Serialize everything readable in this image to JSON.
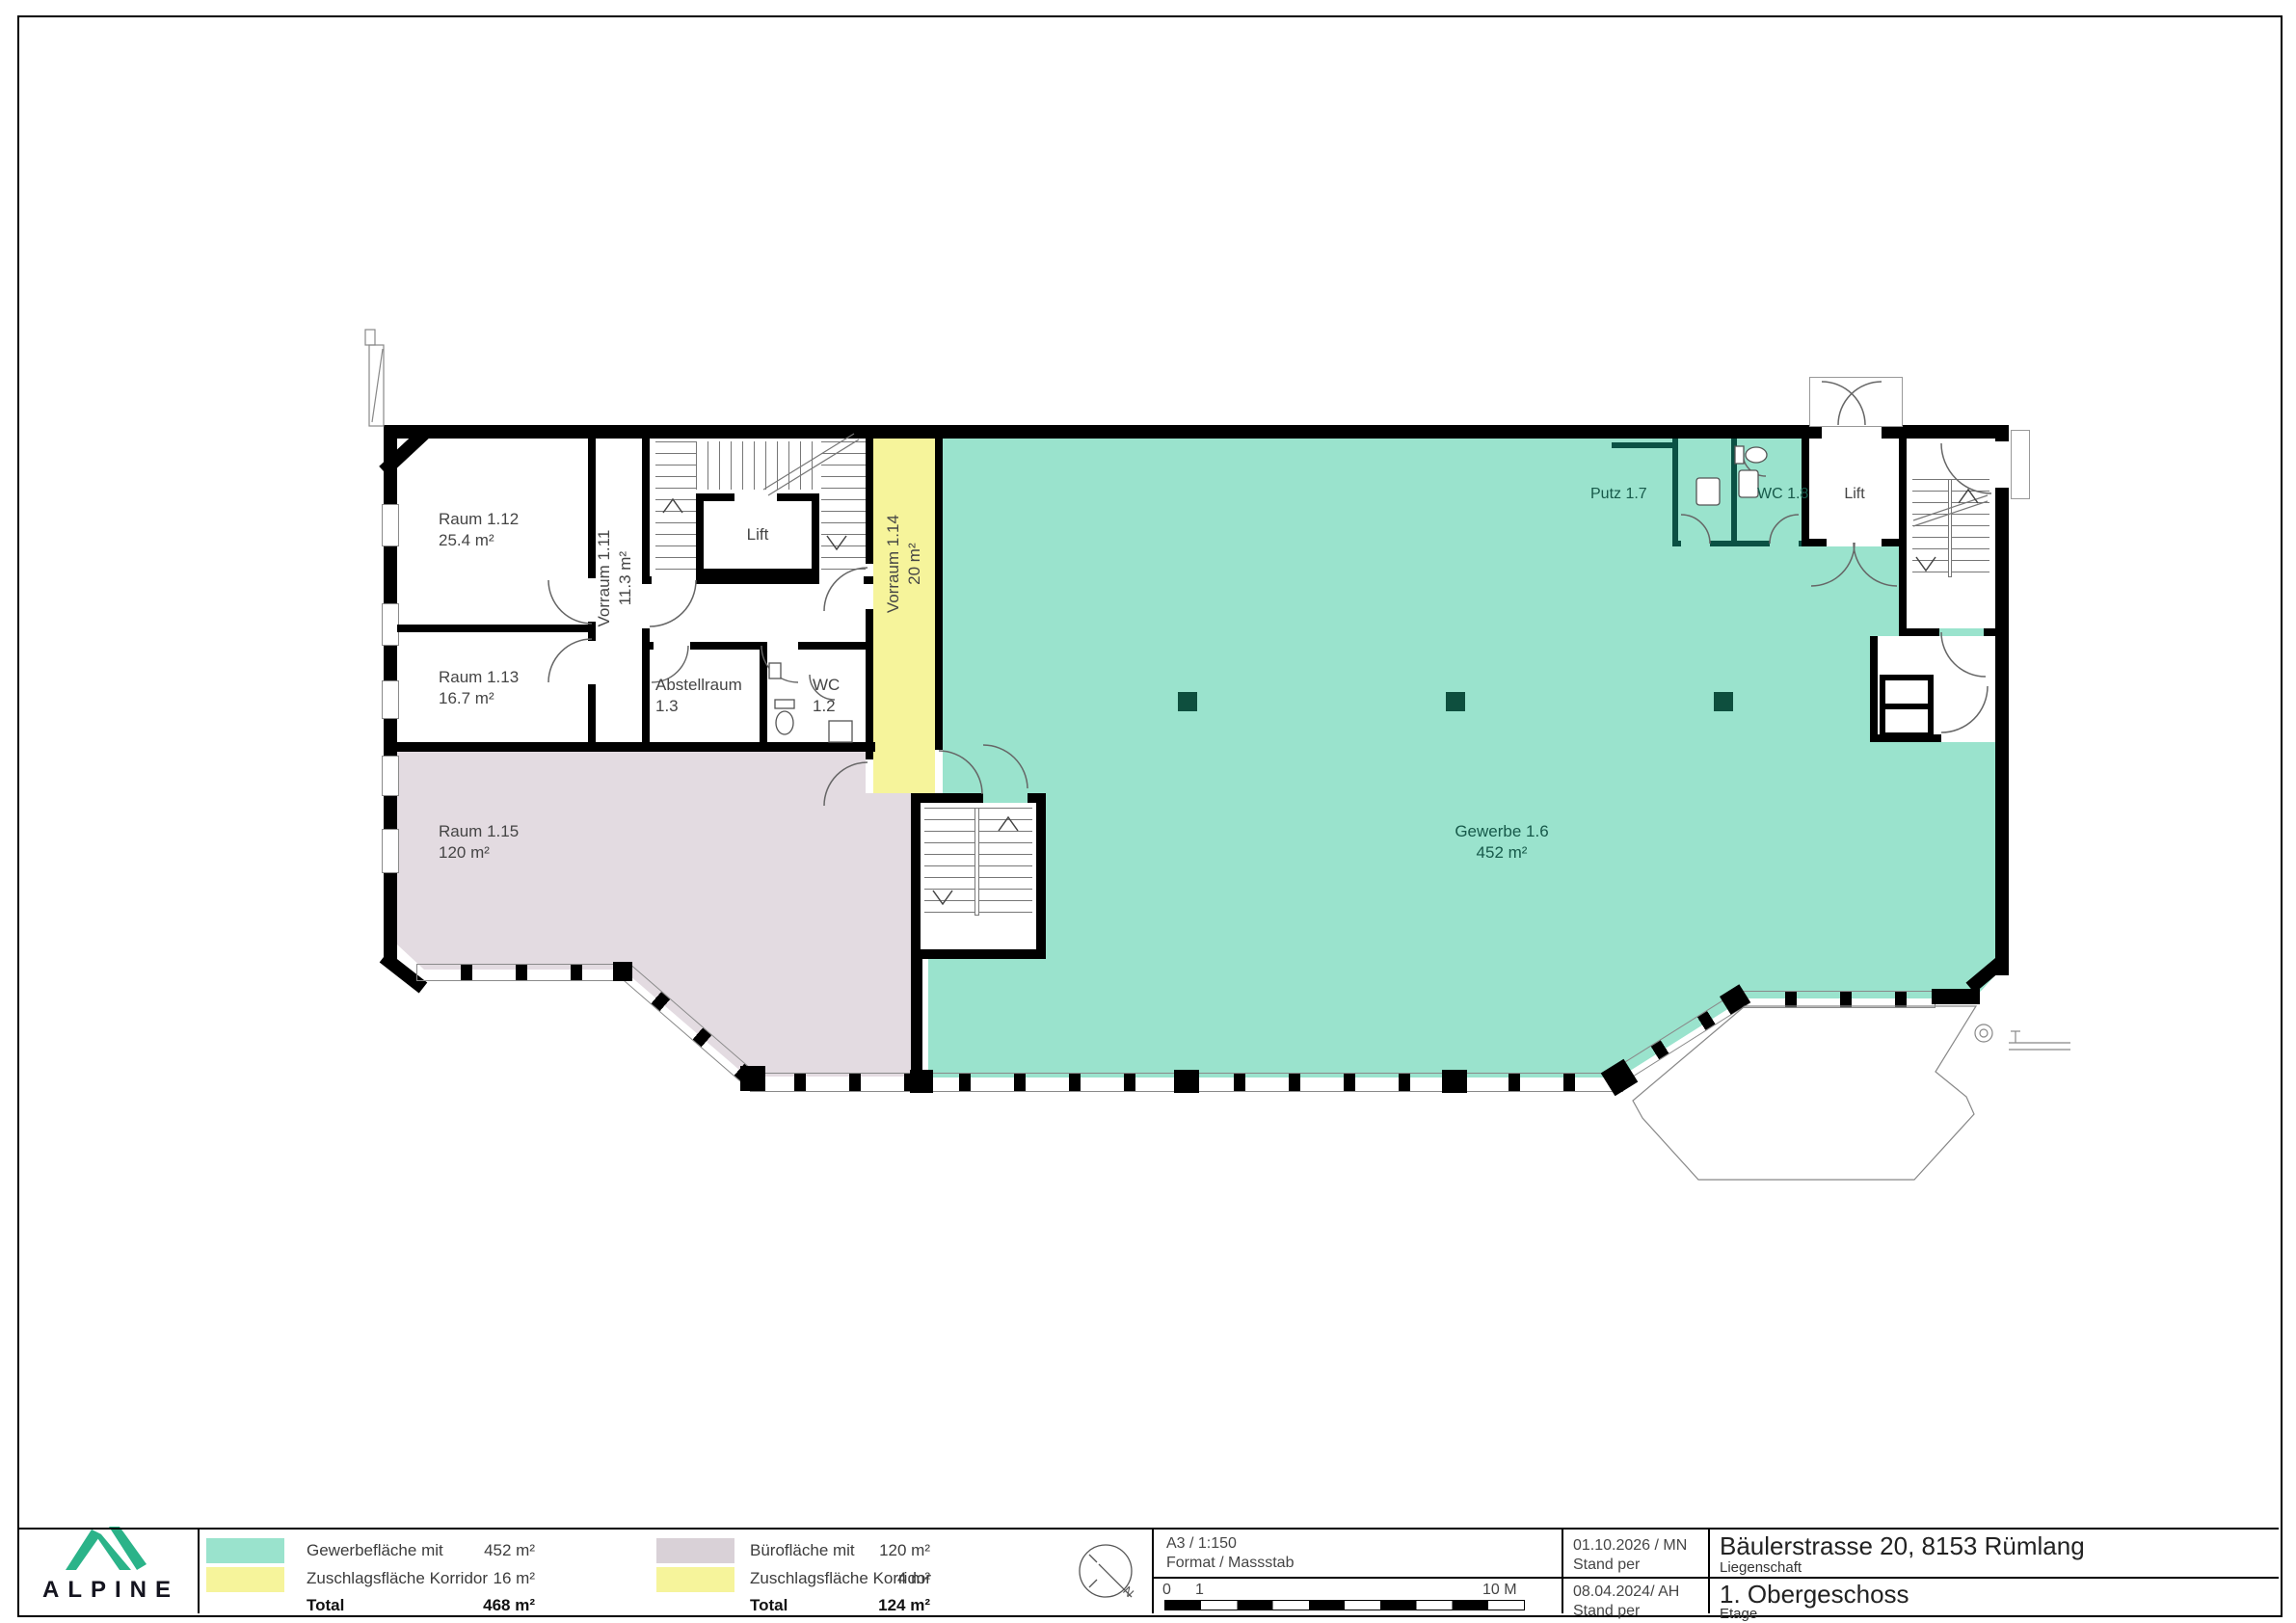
{
  "plan": {
    "rooms": {
      "raum_1_12": {
        "name": "Raum 1.12",
        "area": "25.4 m²"
      },
      "raum_1_13": {
        "name": "Raum 1.13",
        "area": "16.7 m²"
      },
      "vorraum_1_11": {
        "name": "Vorraum 1.11",
        "area": "11.3 m²"
      },
      "lift_west": {
        "name": "Lift"
      },
      "abstellraum_1_3": {
        "name": "Abstellraum",
        "number": "1.3"
      },
      "wc_1_2": {
        "name": "WC",
        "number": "1.2"
      },
      "vorraum_1_14": {
        "name": "Vorraum 1.14",
        "area": "20 m²"
      },
      "raum_1_15": {
        "name": "Raum 1.15",
        "area": "120 m²"
      },
      "gewerbe_1_6": {
        "name": "Gewerbe 1.6",
        "area": "452 m²"
      },
      "putz_1_7": {
        "name": "Putz 1.7"
      },
      "wc_1_8": {
        "name": "WC 1.8"
      },
      "lift_east": {
        "name": "Lift"
      }
    },
    "colors": {
      "gewerbe": "#9ae3cd",
      "korridor": "#f6f49b",
      "buero": "#e3dbe1",
      "wall_teal": "#0b5144",
      "brand_green": "#2bb389"
    }
  },
  "titleblock": {
    "brand": "ALPINE",
    "legend_left": {
      "rows": [
        {
          "label": "Gewerbefläche mit",
          "value": "452 m²"
        },
        {
          "label": "Zuschlagsfläche Korridor",
          "value": "16 m²"
        }
      ],
      "total_label": "Total",
      "total_value": "468 m²"
    },
    "legend_right": {
      "rows": [
        {
          "label": "Bürofläche mit",
          "value": "120 m²"
        },
        {
          "label": "Zuschlagsfläche Korridor",
          "value": "4 m²"
        }
      ],
      "total_label": "Total",
      "total_value": "124 m²"
    },
    "format": {
      "value": "A3 / 1:150",
      "label": "Format / Massstab"
    },
    "scalebar": {
      "zero": "0",
      "one": "1",
      "end": "10 M"
    },
    "stand_top": {
      "value": "01.10.2026 / MN",
      "label": "Stand per"
    },
    "stand_bottom": {
      "value": "08.04.2024/ AH",
      "label": "Stand per"
    },
    "liegenschaft": {
      "value": "Bäulerstrasse 20, 8153 Rümlang",
      "label": "Liegenschaft"
    },
    "etage": {
      "value": "1. Obergeschoss",
      "label": "Etage"
    },
    "compass": {
      "north": "N"
    }
  }
}
